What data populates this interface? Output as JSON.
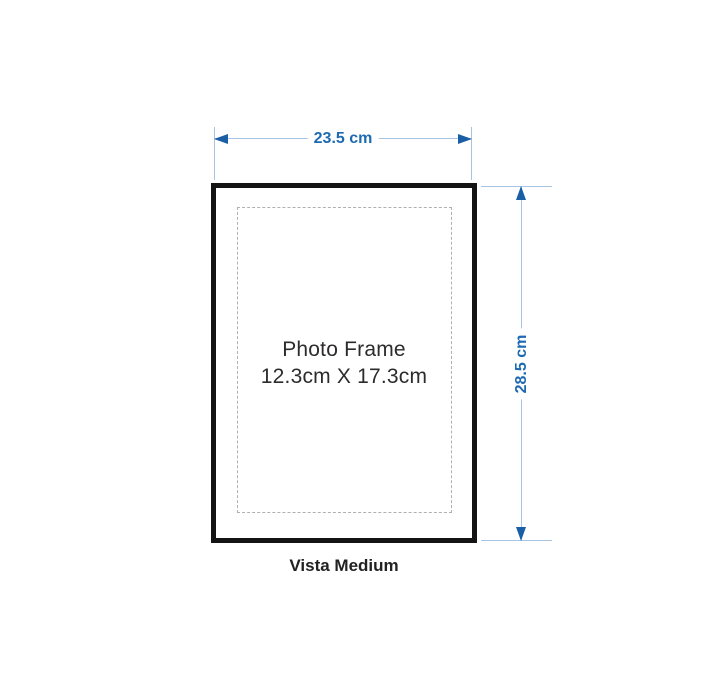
{
  "diagram": {
    "product_name": "Vista Medium",
    "frame_label": {
      "title": "Photo Frame",
      "size": "12.3cm X 17.3cm"
    },
    "dimensions": {
      "width_label": "23.5 cm",
      "height_label": "28.5 cm"
    },
    "colors": {
      "dimension_accent": "#1e6ab2",
      "dimension_arrow": "#1a5fa6",
      "dimension_line": "#a9c4e2",
      "frame_border": "#141414",
      "dashed_opening": "#b3b0ac",
      "label_text": "#2d2b2b",
      "background": "#ffffff"
    }
  }
}
